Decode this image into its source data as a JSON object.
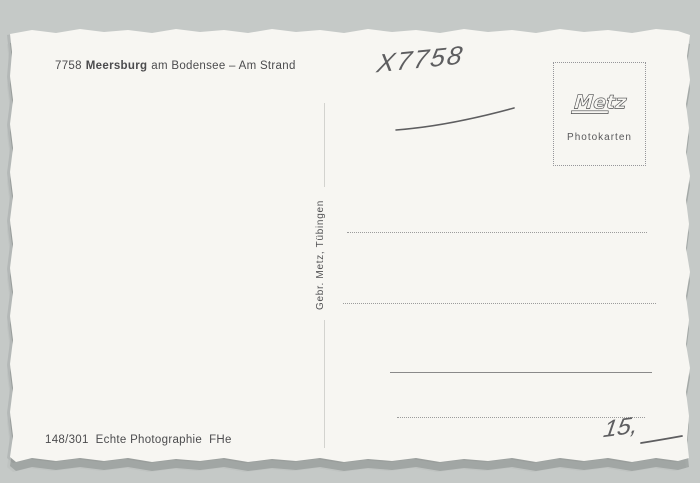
{
  "scene": {
    "background_color": "#c5c9c7",
    "card_color": "#f7f6f2"
  },
  "postcard": {
    "caption": {
      "code": "7758",
      "place": "Meersburg",
      "tail": "am Bodensee – Am Strand"
    },
    "handwriting": {
      "catalog_code": "X7758",
      "price": "15,"
    },
    "stamp_box": {
      "logo": "Metz",
      "label": "Photokarten"
    },
    "spine": {
      "publisher": "Gebr. Metz, Tübingen"
    },
    "footer": {
      "code": "148/301",
      "label": "Echte Photographie",
      "initials": "FHe"
    }
  }
}
